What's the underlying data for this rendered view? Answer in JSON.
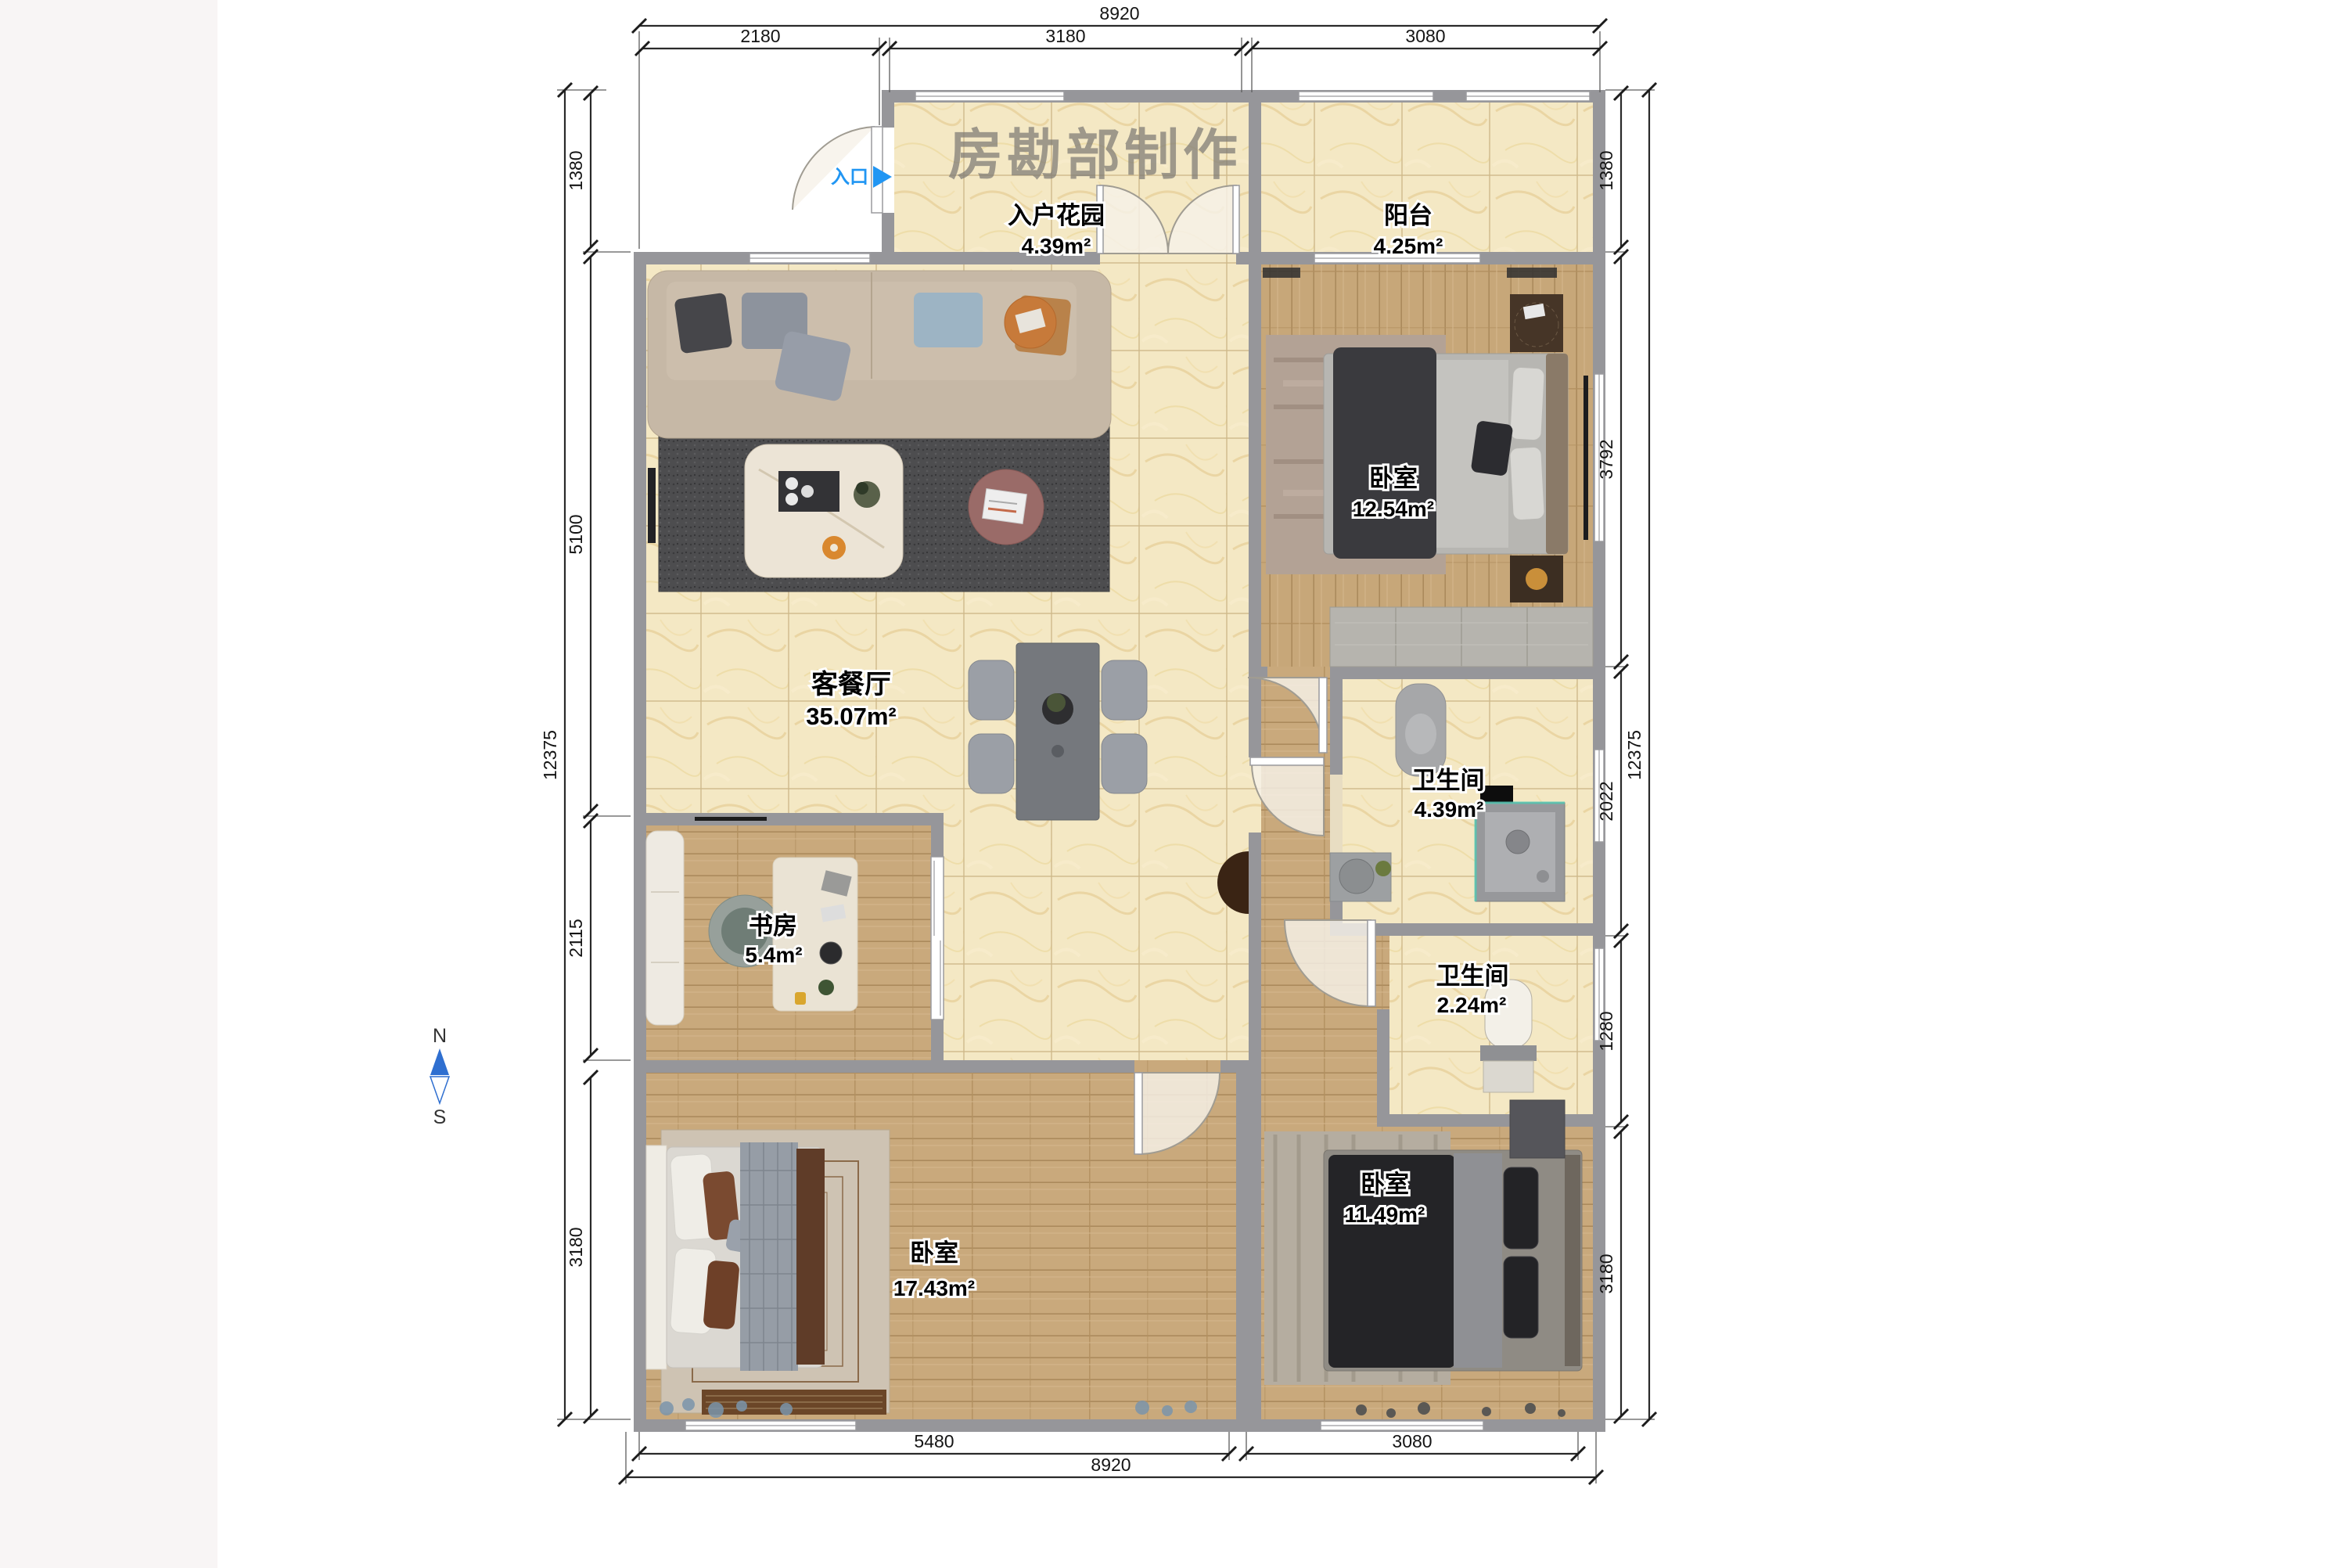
{
  "watermark": "房勘部制作",
  "entrance": {
    "label": "入口"
  },
  "compass": {
    "north": "N",
    "south": "S"
  },
  "rooms": {
    "entry_garden": {
      "name": "入户花园",
      "area": "4.39m²"
    },
    "balcony": {
      "name": "阳台",
      "area": "4.25m²"
    },
    "living_dining": {
      "name": "客餐厅",
      "area": "35.07m²"
    },
    "bedroom_master": {
      "name": "卧室",
      "area": "12.54m²"
    },
    "bathroom_main": {
      "name": "卫生间",
      "area": "4.39m²"
    },
    "bathroom_small": {
      "name": "卫生间",
      "area": "2.24m²"
    },
    "study": {
      "name": "书房",
      "area": "5.4m²"
    },
    "bedroom_left": {
      "name": "卧室",
      "area": "17.43m²"
    },
    "bedroom_right": {
      "name": "卧室",
      "area": "11.49m²"
    }
  },
  "dimensions": {
    "top": {
      "total": "8920",
      "segments": [
        "2180",
        "3180",
        "3080"
      ]
    },
    "bottom": {
      "total": "8920",
      "segments": [
        "5480",
        "3080"
      ]
    },
    "left": {
      "total": "12375",
      "segments": [
        "1380",
        "5100",
        "2115",
        "3180"
      ]
    },
    "right": {
      "total": "12375",
      "segments": [
        "1380",
        "3792",
        "2022",
        "1280",
        "3180"
      ]
    }
  },
  "colors": {
    "wall": "#96969a",
    "tile_floor": "#f4e8c4",
    "wood_floor": "#c9a97c",
    "entrance_blue": "#2196f3",
    "compass_blue": "#2f6fd0",
    "watermark_gray": "#7d7a75"
  }
}
